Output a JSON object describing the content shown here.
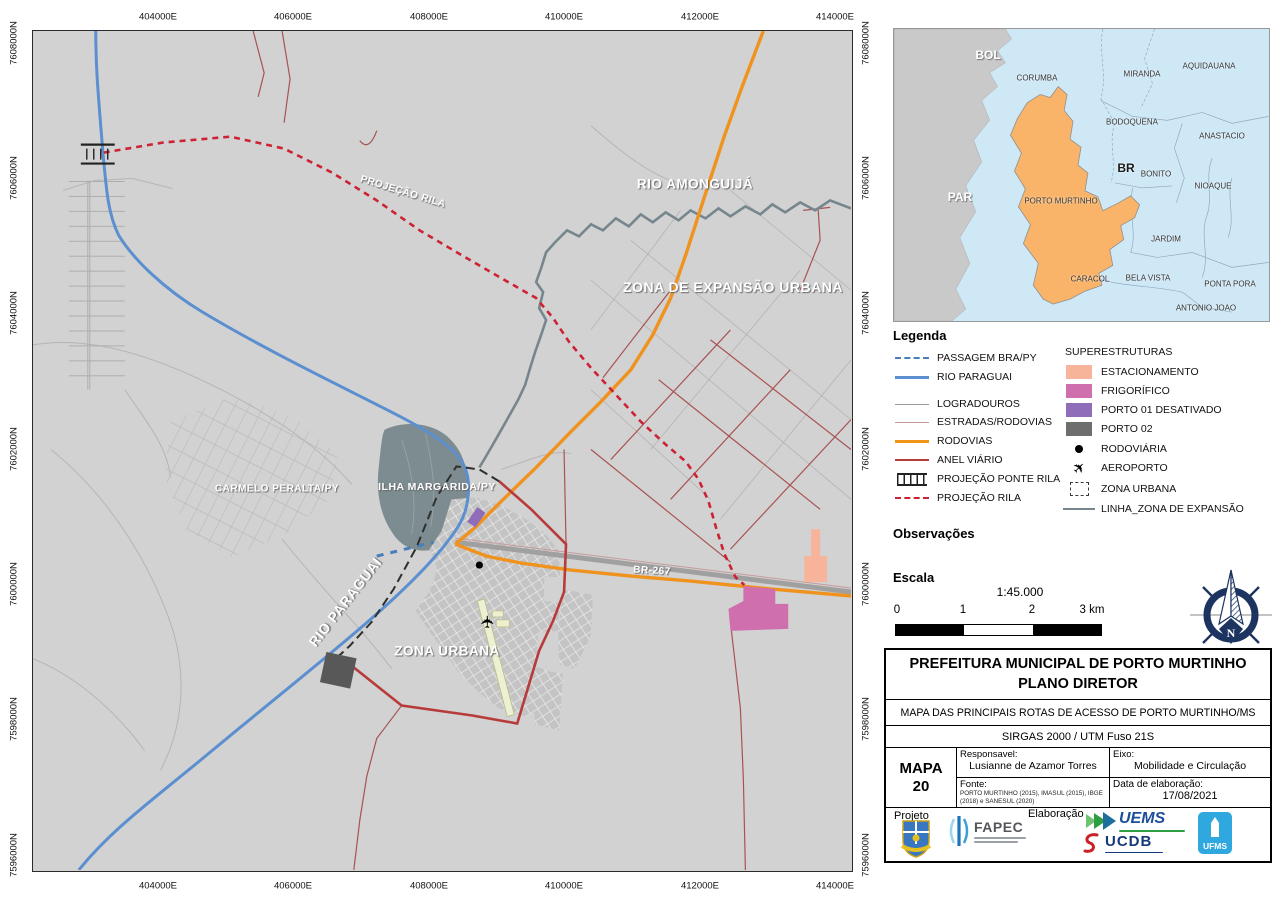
{
  "map": {
    "axis": {
      "eastings": [
        "404000E",
        "406000E",
        "408000E",
        "410000E",
        "412000E",
        "414000E"
      ],
      "northings": [
        "7608000N",
        "7606000N",
        "7604000N",
        "7602000N",
        "7600000N",
        "7598000N",
        "7596000N"
      ]
    },
    "labels": [
      {
        "text": "RIO AMONGUIJÁ",
        "x": 695,
        "y": 184,
        "rot": 0,
        "size": 13.5
      },
      {
        "text": "ZONA DE EXPANSÃO URBANA",
        "x": 733,
        "y": 287,
        "rot": 0,
        "size": 14
      },
      {
        "text": "PROJEÇÃO RILA",
        "x": 403,
        "y": 192,
        "rot": 17,
        "size": 10
      },
      {
        "text": "CARMELO PERALTA/PY",
        "x": 277,
        "y": 489,
        "rot": 0,
        "size": 10
      },
      {
        "text": "ILHA MARGARIDA/PY",
        "x": 437,
        "y": 487,
        "rot": 0,
        "size": 10.5
      },
      {
        "text": "RIO PARAGUAI",
        "x": 345,
        "y": 602,
        "rot": -52,
        "size": 14
      },
      {
        "text": "ZONA URBANA",
        "x": 447,
        "y": 651,
        "rot": 0,
        "size": 13.5
      },
      {
        "text": "BR-267",
        "x": 652,
        "y": 571,
        "rot": 3,
        "size": 10
      }
    ]
  },
  "inset": {
    "labels": [
      {
        "text": "BOL",
        "x": 988,
        "y": 55,
        "style": "big",
        "size": 12
      },
      {
        "text": "CORUMBA",
        "x": 1037,
        "y": 78,
        "style": "sm",
        "size": 8
      },
      {
        "text": "MIRANDA",
        "x": 1142,
        "y": 74,
        "style": "sm",
        "size": 8
      },
      {
        "text": "AQUIDAUANA",
        "x": 1209,
        "y": 66,
        "style": "sm",
        "size": 8
      },
      {
        "text": "BODOQUENA",
        "x": 1132,
        "y": 122,
        "style": "sm",
        "size": 8
      },
      {
        "text": "ANASTACIO",
        "x": 1222,
        "y": 136,
        "style": "sm",
        "size": 8
      },
      {
        "text": "BR",
        "x": 1126,
        "y": 168,
        "style": "dark-big",
        "size": 12
      },
      {
        "text": "BONITO",
        "x": 1156,
        "y": 174,
        "style": "sm",
        "size": 8
      },
      {
        "text": "NIOAQUE",
        "x": 1213,
        "y": 186,
        "style": "sm",
        "size": 8
      },
      {
        "text": "PAR",
        "x": 960,
        "y": 197,
        "style": "big",
        "size": 12
      },
      {
        "text": "PORTO MURTINHO",
        "x": 1061,
        "y": 201,
        "style": "sm",
        "size": 8
      },
      {
        "text": "JARDIM",
        "x": 1166,
        "y": 239,
        "style": "sm",
        "size": 8
      },
      {
        "text": "CARACOL",
        "x": 1090,
        "y": 279,
        "style": "sm",
        "size": 8
      },
      {
        "text": "BELA VISTA",
        "x": 1148,
        "y": 278,
        "style": "sm",
        "size": 8
      },
      {
        "text": "PONTA PORA",
        "x": 1230,
        "y": 284,
        "style": "sm",
        "size": 8
      },
      {
        "text": "ANTONIO JOAO",
        "x": 1206,
        "y": 308,
        "style": "sm",
        "size": 8
      }
    ]
  },
  "legend": {
    "title": "Legenda",
    "left_items": [
      {
        "label": "PASSAGEM BRA/PY",
        "type": "dashed-line",
        "color": "#4a7ebb",
        "lw": 2.5
      },
      {
        "label": "RIO PARAGUAI",
        "type": "line",
        "color": "#5b8fd0",
        "lw": 3
      },
      {
        "label": "LOGRADOUROS",
        "type": "line",
        "color": "#9a9a9a",
        "lw": 1.5
      },
      {
        "label": "ESTRADAS/RODOVIAS",
        "type": "line",
        "color": "#c79a9a",
        "lw": 1.5
      },
      {
        "label": "RODOVIAS",
        "type": "line",
        "color": "#ef9417",
        "lw": 3
      },
      {
        "label": "ANEL VIÁRIO",
        "type": "line",
        "color": "#b73b3b",
        "lw": 2.5
      },
      {
        "label": "PROJEÇÃO PONTE RILA",
        "type": "bridge",
        "color": "#222222",
        "lw": 2
      },
      {
        "label": "PROJEÇÃO RILA",
        "type": "dashed-line",
        "color": "#cc2233",
        "lw": 2.5
      }
    ],
    "right_title": "SUPERESTRUTURAS",
    "right_items": [
      {
        "label": "ESTACIONAMENTO",
        "type": "swatch",
        "color": "#f8b49b"
      },
      {
        "label": "FRIGORÍFICO",
        "type": "swatch",
        "color": "#cf6fae"
      },
      {
        "label": "PORTO 01  DESATIVADO",
        "type": "swatch",
        "color": "#8f6db8"
      },
      {
        "label": "PORTO 02",
        "type": "swatch",
        "color": "#6e6e6e"
      },
      {
        "label": "RODOVIÁRIA",
        "type": "dot",
        "color": "#000000"
      },
      {
        "label": "AEROPORTO",
        "type": "plane",
        "color": "#000000"
      },
      {
        "label": "ZONA URBANA",
        "type": "dashed-rect",
        "color": "#3a3a3a"
      },
      {
        "label": "LINHA_ZONA DE EXPANSÃO",
        "type": "line",
        "color": "#76868c",
        "lw": 2.5
      }
    ]
  },
  "observacoes_title": "Observações",
  "scale": {
    "title": "Escala",
    "ratio": "1:45.000",
    "ticks": [
      "0",
      "1",
      "2",
      "3 km"
    ]
  },
  "compass_n": "N",
  "title_block": {
    "line1": "PREFEITURA MUNICIPAL DE PORTO MURTINHO",
    "line2": "PLANO DIRETOR",
    "subtitle": "MAPA DAS PRINCIPAIS ROTAS DE ACESSO DE PORTO MURTINHO/MS",
    "datum": "SIRGAS 2000 / UTM Fuso 21S",
    "map_no_1": "MAPA",
    "map_no_2": "20",
    "responsavel_label": "Responsavel:",
    "responsavel": "Lusianne de Azamor Torres",
    "eixo_label": "Eixo:",
    "eixo": "Mobilidade e Circulação",
    "fonte_label": "Fonte:",
    "fonte": "PORTO MURTINHO (2015), IMASUL (2015), IBGE (2018) e SANESUL (2020)",
    "data_label": "Data de elaboração:",
    "data": "17/08/2021",
    "projeto_label": "Projeto",
    "elaboracao_label": "Elaboração",
    "logos": {
      "fapec": "FAPEC",
      "uems": "UEMS",
      "ucdb": "UCDB",
      "ufms": "UFMS"
    }
  }
}
